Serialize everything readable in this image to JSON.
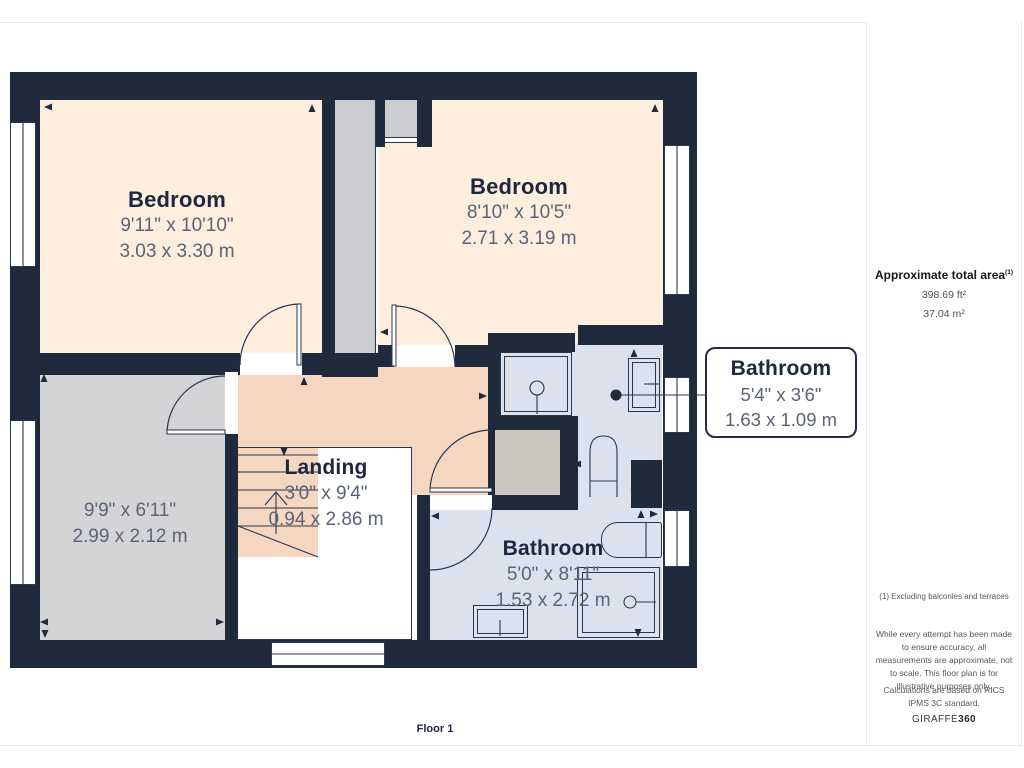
{
  "plan": {
    "floor_label": "Floor 1",
    "rooms": {
      "bedroom1": {
        "name": "Bedroom",
        "dims_imperial": "9'11\" x 10'10\"",
        "dims_metric": "3.03 x 3.30 m"
      },
      "bedroom2": {
        "name": "Bedroom",
        "dims_imperial": "8'10\" x 10'5\"",
        "dims_metric": "2.71 x 3.19 m"
      },
      "gray_room": {
        "dims_imperial": "9'9\" x 6'11\"",
        "dims_metric": "2.99 x 2.12 m"
      },
      "landing": {
        "name": "Landing",
        "dims_imperial": "3'0\" x 9'4\"",
        "dims_metric": "0.94 x 2.86 m"
      },
      "bathroom_callout": {
        "name": "Bathroom",
        "dims_imperial": "5'4\" x 3'6\"",
        "dims_metric": "1.63 x 1.09 m"
      },
      "bathroom": {
        "name": "Bathroom",
        "dims_imperial": "5'0\" x 8'11\"",
        "dims_metric": "1.53 x 2.72 m"
      }
    }
  },
  "sidebar": {
    "total_area_label": "Approximate total area",
    "total_area_footnote_ref": "(1)",
    "total_area_ft": "398.69 ft²",
    "total_area_m": "37.04 m²",
    "footnote": "(1) Excluding balconies and terraces",
    "disclaimer": "While every attempt has been made to ensure accuracy, all measurements are approximate, not to scale. This floor plan is for illustrative purposes only.",
    "standard_note": "Calculations are based on RICS IPMS 3C standard.",
    "brand_prefix": "GIRAFFE",
    "brand_suffix": "360"
  },
  "colors": {
    "wall": "#202a3d",
    "cream": "#fdeedd",
    "salmon": "#f5d6c1",
    "grayroom": "#d4d4d6",
    "shaft": "#cbcdd1",
    "warmgray": "#ccc6c0",
    "blue": "#dce1ed",
    "ink": "#1d2840",
    "dim": "#5a6378",
    "line": "#2a3550",
    "pageline": "#e7e7e7",
    "muted": "#55585e"
  }
}
